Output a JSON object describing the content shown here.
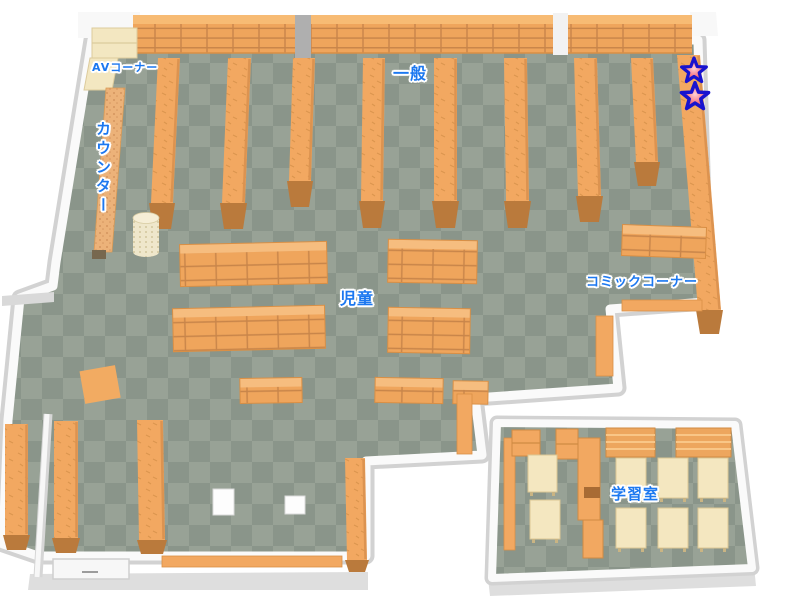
{
  "page": {
    "kind": "library-floor-map",
    "background": "#ffffff"
  },
  "map": {
    "areas": [
      {
        "id": "av-corner",
        "label": "AVコーナー"
      },
      {
        "id": "counter",
        "label": "カウンター"
      },
      {
        "id": "general",
        "label": "一般"
      },
      {
        "id": "children",
        "label": "児童"
      },
      {
        "id": "comic-corner",
        "label": "コミックコーナー"
      },
      {
        "id": "study-room",
        "label": "学習室"
      }
    ],
    "markers": {
      "star_count": 2
    },
    "colors": {
      "floor_light": "#98A296",
      "floor_dark": "#8A958A",
      "shelf_orange": "#F2A861",
      "shelf_grid": "#C8854A",
      "shelf_end_cap": "#BA7A3C",
      "desk_cream": "#F4E7C0",
      "wall_white": "#FAFAFA",
      "wall_shadow": "#D2D2D2",
      "label_blue": "#1C78F0",
      "star_outline": "#1813CF",
      "star_fill": "#E3294B"
    }
  }
}
